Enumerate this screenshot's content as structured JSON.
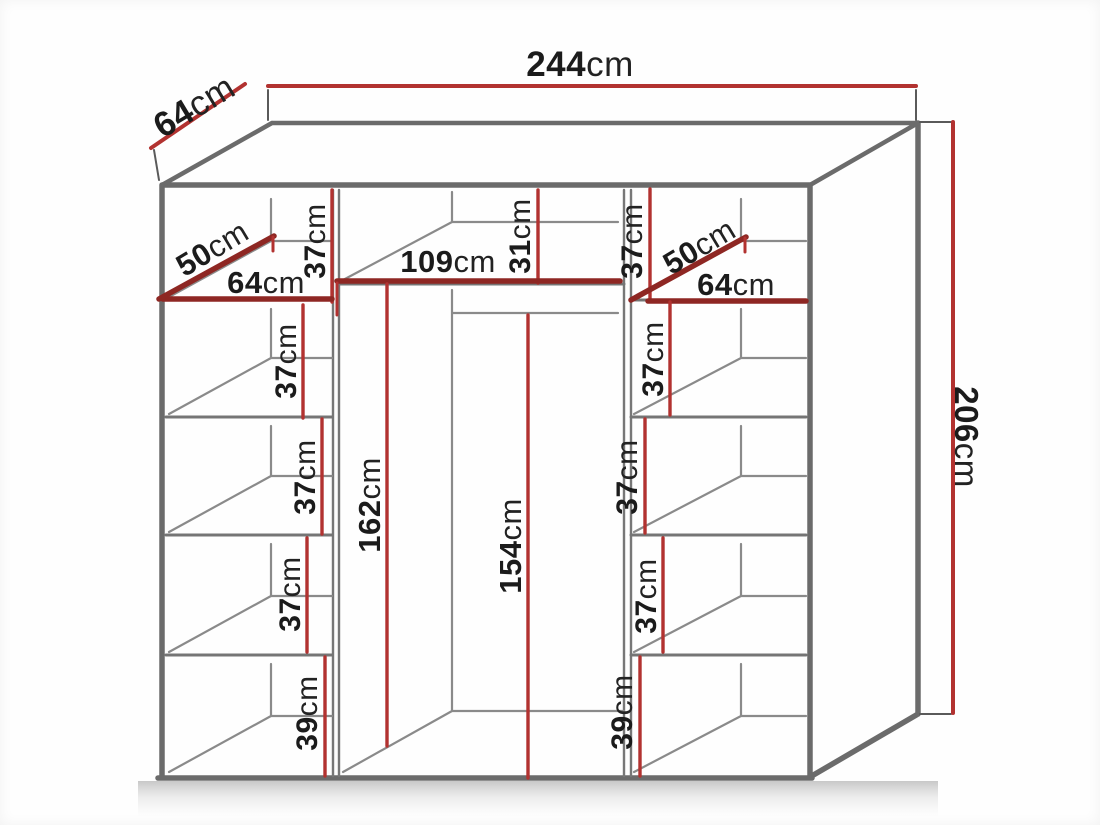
{
  "title": "Wardrobe dimension diagram",
  "colors": {
    "dimension_line": "#b23230",
    "dimension_line_dark": "#8e2723",
    "structure_line": "#6b6b6b",
    "label_text": "#1b1b1b"
  },
  "overall": {
    "width": {
      "num": "244",
      "unit": "cm"
    },
    "depth": {
      "num": "64",
      "unit": "cm"
    },
    "height": {
      "num": "206",
      "unit": "cm"
    }
  },
  "left_column": {
    "top_cell_height": {
      "num": "37",
      "unit": "cm"
    },
    "shelf_depth": {
      "num": "50",
      "unit": "cm"
    },
    "shelf_width": {
      "num": "64",
      "unit": "cm"
    },
    "cell_heights": [
      {
        "num": "37",
        "unit": "cm"
      },
      {
        "num": "37",
        "unit": "cm"
      },
      {
        "num": "37",
        "unit": "cm"
      },
      {
        "num": "39",
        "unit": "cm"
      }
    ]
  },
  "middle_section": {
    "top_shelf_width": {
      "num": "109",
      "unit": "cm"
    },
    "top_cell_height": {
      "num": "31",
      "unit": "cm"
    },
    "left_hanging_height": {
      "num": "162",
      "unit": "cm"
    },
    "right_hanging_height": {
      "num": "154",
      "unit": "cm"
    }
  },
  "right_column": {
    "top_cell_height": {
      "num": "37",
      "unit": "cm"
    },
    "shelf_depth": {
      "num": "50",
      "unit": "cm"
    },
    "shelf_width": {
      "num": "64",
      "unit": "cm"
    },
    "cell_heights": [
      {
        "num": "37",
        "unit": "cm"
      },
      {
        "num": "37",
        "unit": "cm"
      },
      {
        "num": "37",
        "unit": "cm"
      },
      {
        "num": "39",
        "unit": "cm"
      }
    ]
  }
}
